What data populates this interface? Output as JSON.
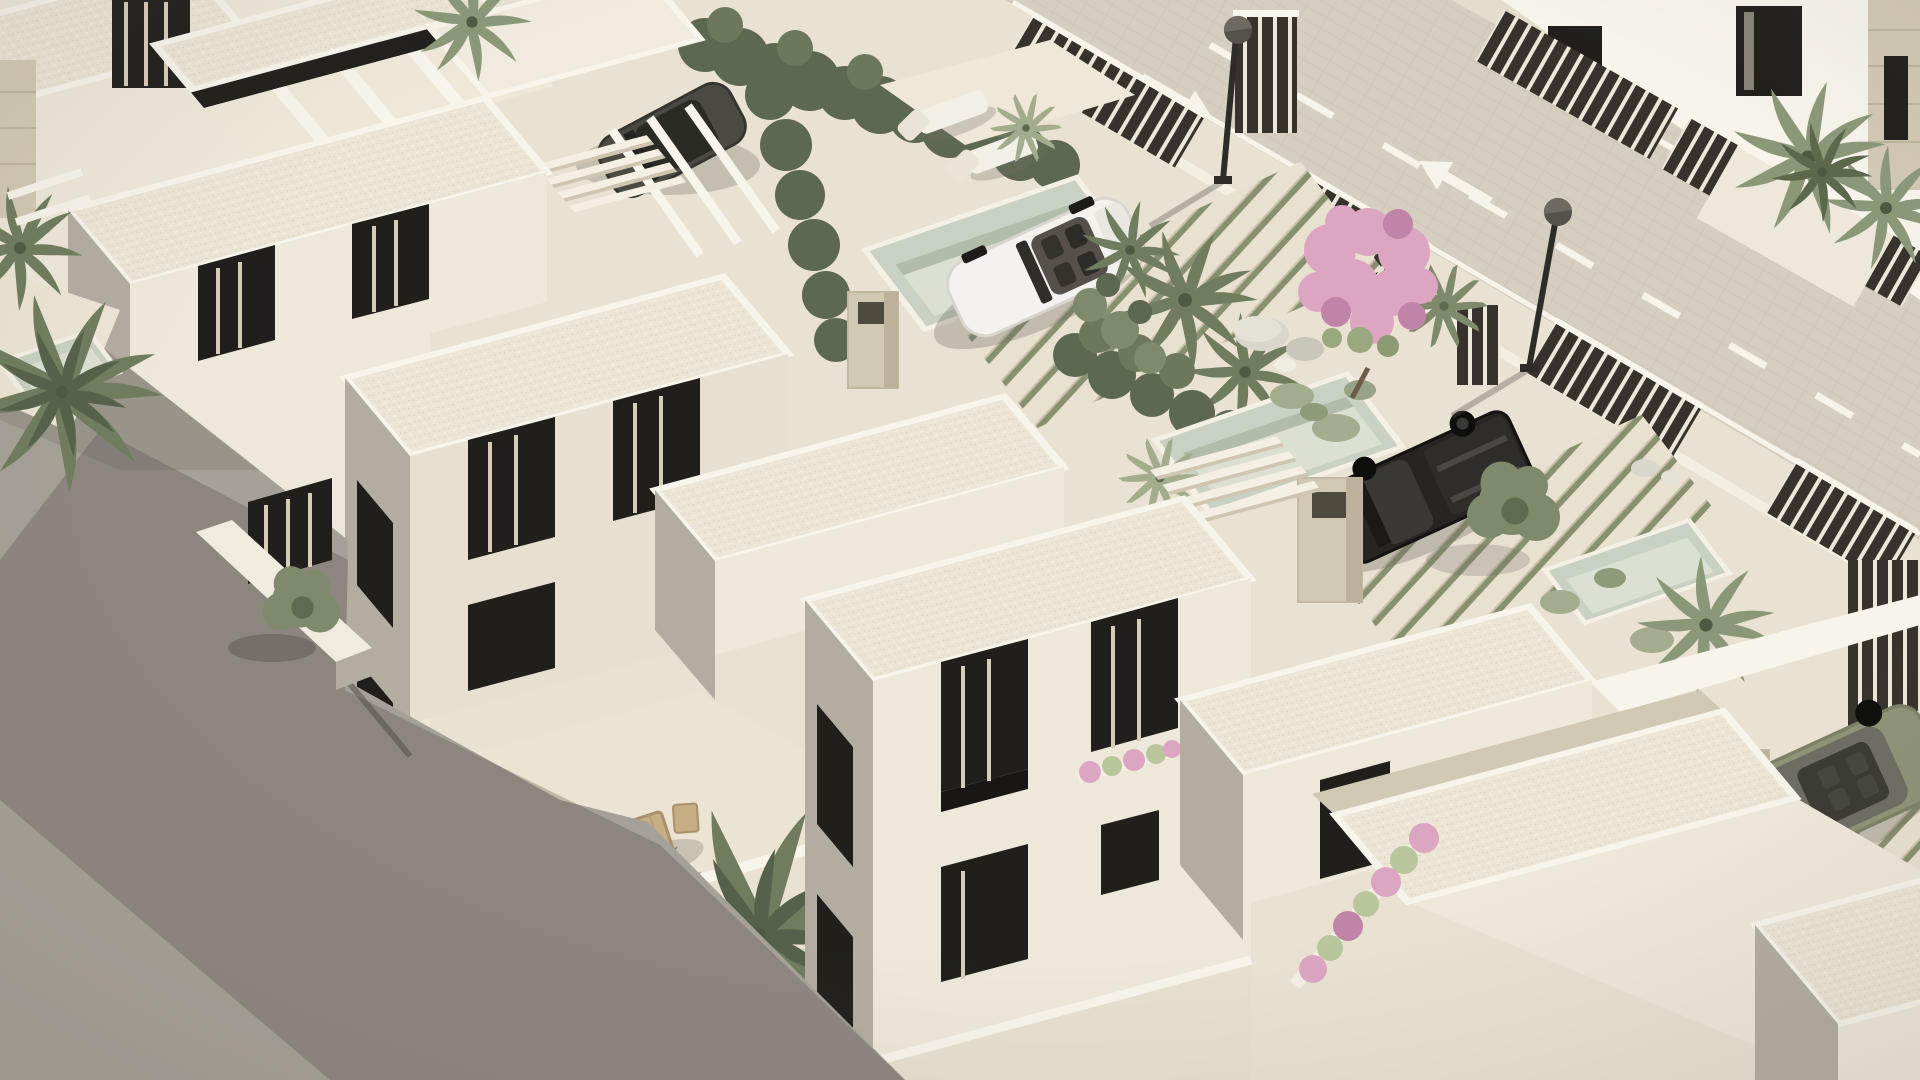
{
  "meta": {
    "type": "architectural-3d-render",
    "view": "aerial oblique",
    "setting": "modern white villa development with private plunge pools, gravel flat roofs, slatted fences and a paved street",
    "time_of_day": "day"
  },
  "palette": {
    "wallLit": "#eee8da",
    "wallBright": "#f7f4ec",
    "wallShade": "#b3ada1",
    "wallDark": "#8e8b84",
    "glass": "#201f1c",
    "curtain": "#d6cdb9",
    "roofGravel": "#ece4d4",
    "street": "#d6cec0",
    "streetLine": "#f6f3ea",
    "sidewalk": "#e4ddcd",
    "yard": "#e9e2d2",
    "ground": "#a6a198",
    "groundShadow": "#6f6b64",
    "pool": "#c8d1c3",
    "poolFloor": "#dce0d3",
    "poolDeep": "#b2bcab",
    "hedge": "#5d6850",
    "green": "#7e8a6b",
    "greenLight": "#a3ad8e",
    "palm": "#6f7c5d",
    "palmLight": "#8b9878",
    "bougainvillea": "#dca6c2",
    "bougainvilleaDeep": "#c084a8",
    "flowerGreen": "#b9c69c",
    "fence": "#37332c",
    "fenceLight": "#ece7da",
    "stone": "#d2c9b4",
    "stoneShade": "#bcb29b",
    "wood": "#c7ae85",
    "woodDark": "#a98f6a",
    "carWhite": "#f3f2ef",
    "carDark": "#262523",
    "carOlive": "#8e9377",
    "carGray": "#4a4a42",
    "lamp": "#2e2c29"
  },
  "scene": {
    "street": {
      "lamp_count": 2,
      "arrow_markings": 2,
      "lane_line": "dashed white"
    },
    "vehicles": [
      {
        "name": "dark-hatchback",
        "location": "top carport under pergola beams"
      },
      {
        "name": "white-convertible",
        "location": "first driveway, top down, two dark seats"
      },
      {
        "name": "black-pickup",
        "location": "middle driveway"
      },
      {
        "name": "olive-suv",
        "location": "right driveway, dark roof with sunroof"
      }
    ],
    "pools": 4,
    "vegetation": [
      "cypress-hedge",
      "palm-trees",
      "agaves",
      "ornamental-grass",
      "bougainvillea",
      "round-trees",
      "flower-planters"
    ],
    "furniture": [
      "sun-loungers",
      "outdoor-dining-set"
    ],
    "details": [
      "slatted-dark-fences",
      "stone-pillars",
      "decorative-boulders",
      "external-stairs",
      "street-lamps",
      "gravel-roofs",
      "white-parapets"
    ]
  }
}
